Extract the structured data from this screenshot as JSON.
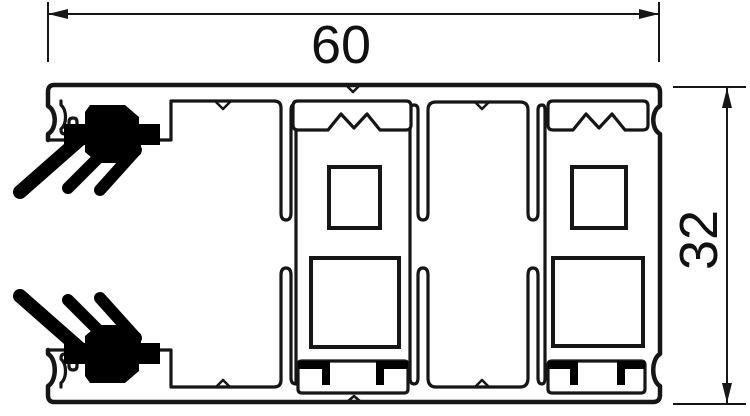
{
  "drawing": {
    "dimensions": {
      "width": "60",
      "height": "32"
    },
    "colors": {
      "line": "#161616",
      "gasket": "#000000",
      "background": "#ffffff"
    }
  }
}
